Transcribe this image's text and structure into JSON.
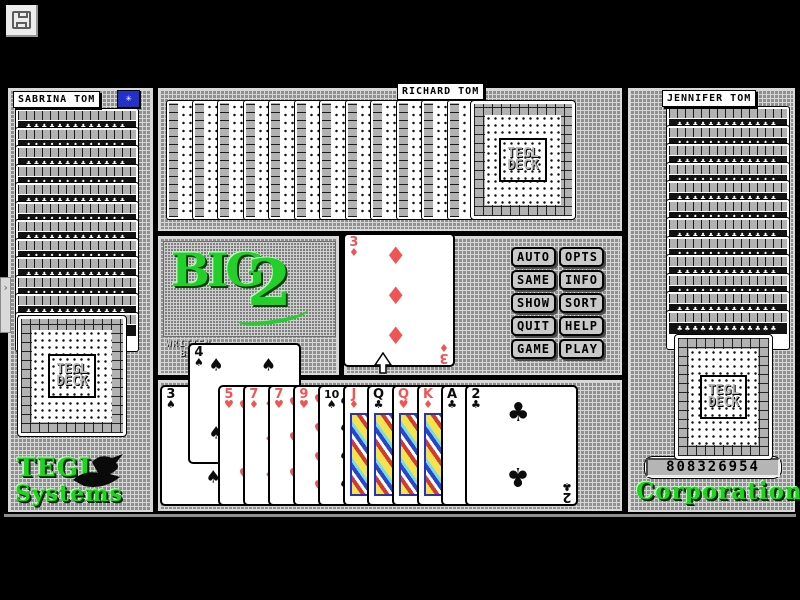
{
  "window": {
    "save_button_icon": "floppy-disk-icon",
    "side_tab_icon": "chevron-right-icon"
  },
  "icons": {
    "star": "✳",
    "chevron": "›"
  },
  "glyphs": {
    "spade": "♠",
    "heart": "♥",
    "diamond": "♦",
    "club": "♣"
  },
  "colors": {
    "red_suit": "#f05454",
    "green_brand": "#1fd41f",
    "star_button_blue": "#2431c8",
    "mesh_gray": "#8f8f8f"
  },
  "players": {
    "left": {
      "name": "SABRINA TOM",
      "back_rows": 12,
      "deck_card": true
    },
    "top": {
      "name": "RICHARD TOM",
      "back_rows": 12,
      "deck_card": true
    },
    "right": {
      "name": "JENNIFER TOM",
      "back_rows": 12,
      "deck_card": true
    }
  },
  "deck_card_label": {
    "line1": "TEGL",
    "line2": "DECK"
  },
  "logo": {
    "word": "BIG",
    "numeral": "2",
    "credit_line1": "WRITTEN",
    "credit_line2": "BY"
  },
  "branding": {
    "left_line1": "TEGL",
    "left_line2": "Systems",
    "right_line": "Corporation",
    "serial": "808326954"
  },
  "command_buttons": [
    "AUTO",
    "OPTS",
    "SAME",
    "INFO",
    "SHOW",
    "SORT",
    "QUIT",
    "HELP",
    "GAME",
    "PLAY"
  ],
  "center_pile": {
    "rank": "3",
    "suit": "diamond"
  },
  "hand": [
    {
      "rank": "3",
      "suit": "spade"
    },
    {
      "rank": "4",
      "suit": "spade",
      "raised": true
    },
    {
      "rank": "5",
      "suit": "heart"
    },
    {
      "rank": "7",
      "suit": "diamond"
    },
    {
      "rank": "7",
      "suit": "heart"
    },
    {
      "rank": "9",
      "suit": "heart"
    },
    {
      "rank": "10",
      "suit": "spade"
    },
    {
      "rank": "J",
      "suit": "diamond",
      "face": true
    },
    {
      "rank": "Q",
      "suit": "club",
      "face": true
    },
    {
      "rank": "Q",
      "suit": "heart",
      "face": true
    },
    {
      "rank": "K",
      "suit": "diamond",
      "face": true
    },
    {
      "rank": "A",
      "suit": "club"
    },
    {
      "rank": "2",
      "suit": "club"
    }
  ]
}
